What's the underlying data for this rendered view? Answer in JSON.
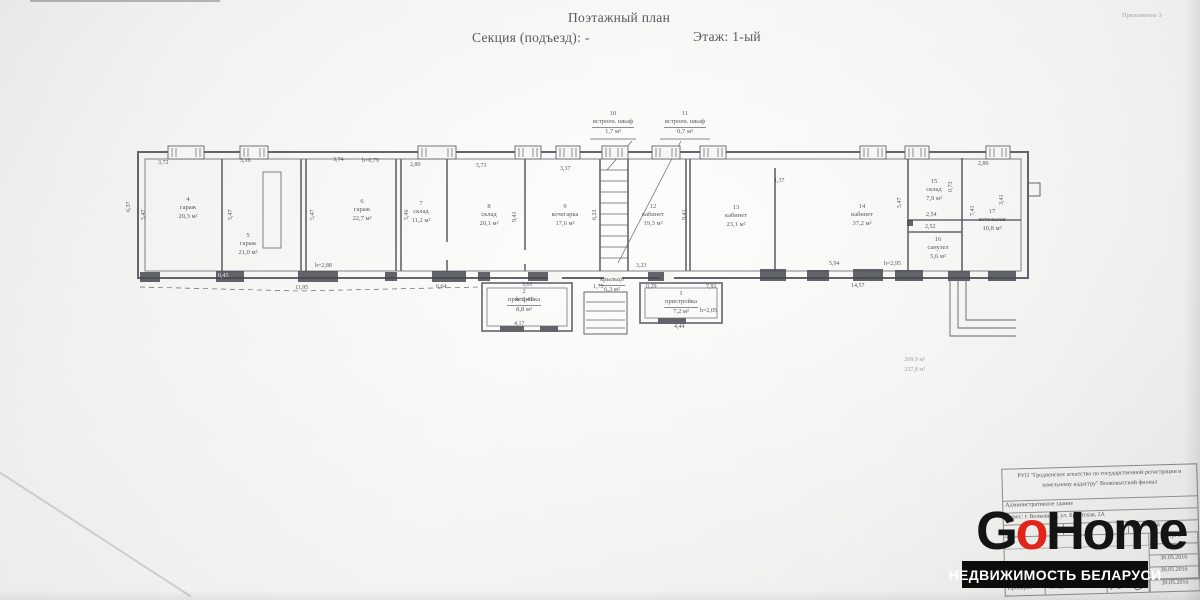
{
  "header": {
    "attachment": "Приложение 3",
    "title": "Поэтажный план",
    "section": "Секция (подъезд): -",
    "floor": "Этаж: 1-ый"
  },
  "plan": {
    "rooms": [
      {
        "num": "4",
        "name": "гараж",
        "area": "20,3 м²"
      },
      {
        "num": "5",
        "name": "гараж",
        "area": "21,0 м²"
      },
      {
        "num": "6",
        "name": "гараж",
        "area": "22,7 м²"
      },
      {
        "num": "7",
        "name": "склад",
        "area": "11,2 м²"
      },
      {
        "num": "8",
        "name": "склад",
        "area": "20,1 м²"
      },
      {
        "num": "9",
        "name": "кочегарка",
        "area": "17,6 м²"
      },
      {
        "num": "10",
        "name": "встроен. шкаф",
        "area": "1,7 м²"
      },
      {
        "num": "11",
        "name": "встроен. шкаф",
        "area": "0,7 м²"
      },
      {
        "num": "12",
        "name": "кабинет",
        "area": "19,3 м²"
      },
      {
        "num": "13",
        "name": "кабинет",
        "area": "23,1 м²"
      },
      {
        "num": "14",
        "name": "кабинет",
        "area": "37,2 м²"
      },
      {
        "num": "15",
        "name": "склад",
        "area": "7,9 м²"
      },
      {
        "num": "16",
        "name": "санузел",
        "area": "5,6 м²"
      },
      {
        "num": "17",
        "name": "котельная",
        "area": "10,8 м²"
      },
      {
        "num": "2",
        "name": "пристройка",
        "area": "8,8 м²"
      },
      {
        "num": "1",
        "name": "пристройка",
        "area": "7,2 м²"
      },
      {
        "num": "",
        "name": "крыльцо",
        "area": "6,3 м²"
      }
    ],
    "totals": [
      "209,9 м²",
      "237,8 м²"
    ],
    "dims": [
      "3,72",
      "3,16",
      "3,74",
      "h=0,79",
      "2,80",
      "5,73",
      "3,37",
      "6,37",
      "5,47",
      "5,47",
      "5,47",
      "5,46",
      "9,41",
      "6,22",
      "9,41",
      "5,47",
      "7,41",
      "3,41",
      "0,45",
      "11,95",
      "h=2,88",
      "6,64",
      "3,61",
      "1,75",
      "0,29",
      "3,23",
      "7,91",
      "5,94",
      "h=2,95",
      "14,57",
      "2,86",
      "1,37",
      "2,54",
      "2,52",
      "0,73",
      "h=2,41",
      "4,17",
      "4,44",
      "h=2,05"
    ]
  },
  "titleblock": {
    "org": "РУП \"Гродненское агентство по государственной регистрации и земельному кадастру\" Волковысский филиал",
    "object": "Административное здание",
    "address": "Адрес: г. Волковыск, ул. Брестская, 2А",
    "floor": "Этаж: 1-ый",
    "page": "Стр. 8",
    "date_label": "Дата",
    "dates": [
      "30.05.2016",
      "30.05.2016"
    ],
    "checked_label": "Проверил",
    "checked_name": "Т.В. Дычкова",
    "checked_date": "30.05.2016"
  },
  "logo": {
    "g": "G",
    "o": "o",
    "home": "Home",
    "tagline": "НЕДВИЖИМОСТЬ БЕЛАРУСИ",
    "red": "#e0251b",
    "black": "#141414"
  }
}
